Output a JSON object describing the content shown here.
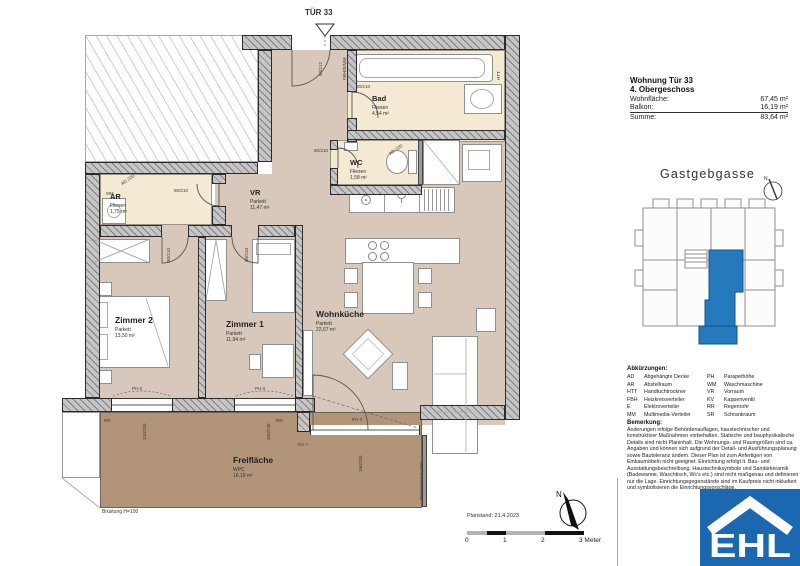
{
  "info": {
    "title": "Wohnung Tür 33",
    "floor": "4. Obergeschoss",
    "rows": [
      {
        "label": "Wohnfläche:",
        "value": "67,45 m²"
      },
      {
        "label": "Balkon:",
        "value": "16,19 m²"
      },
      {
        "label": "Summe:",
        "value": "83,64 m²"
      }
    ]
  },
  "siteplan": {
    "street": "Gastgebgasse"
  },
  "plan": {
    "rooms": [
      {
        "name": "Bad",
        "floor": "Fliesen",
        "area": "4,54 m²"
      },
      {
        "name": "WC",
        "floor": "Fliesen",
        "area": "1,58 m²"
      },
      {
        "name": "AR",
        "floor": "Fliesen",
        "area": "1,75 m²"
      },
      {
        "name": "VR",
        "floor": "Parkett",
        "area": "11,47 m²"
      },
      {
        "name": "Zimmer 1",
        "floor": "Parkett",
        "area": "11,94 m²"
      },
      {
        "name": "Zimmer 2",
        "floor": "Parkett",
        "area": "13,50 m²"
      },
      {
        "name": "Wohnküche",
        "floor": "Parkett",
        "area": "22,67 m²"
      },
      {
        "name": "Freifläche",
        "floor": "WPC",
        "area": "16,19 m²"
      }
    ],
    "annotations": {
      "tuer": "TÜR 33",
      "entry_dim": "90/212",
      "installs": "FBH/E/MM",
      "door_dim": "80/210",
      "ad": "AD 220",
      "htt": "HTT",
      "wm": "WM",
      "ph0": "PH 0",
      "rr": "RR",
      "kv": "KV ×",
      "win_dim": "200/235",
      "terrace_door_dim": "190/235",
      "bruestung": "Brüstung H=100",
      "trennwand": "Trennwand H=200",
      "north": "N"
    }
  },
  "abbreviations": {
    "heading": "Abkürzungen:",
    "items": [
      {
        "abbr": "AD",
        "term": "Abgehängte Decke"
      },
      {
        "abbr": "AR",
        "term": "Abstellraum"
      },
      {
        "abbr": "HTT",
        "term": "Handtuchtrockner"
      },
      {
        "abbr": "FBH",
        "term": "Heizkreisverteiler"
      },
      {
        "abbr": "E",
        "term": "Elektroverteiler"
      },
      {
        "abbr": "MM",
        "term": "Multimedia-Verteiler"
      },
      {
        "abbr": "PH",
        "term": "Parapethöhe"
      },
      {
        "abbr": "WM",
        "term": "Waschmaschine"
      },
      {
        "abbr": "VR",
        "term": "Vorraum"
      },
      {
        "abbr": "KV",
        "term": "Kappenventil"
      },
      {
        "abbr": "RR",
        "term": "Regenrohr"
      },
      {
        "abbr": "SR",
        "term": "Schrankraum"
      }
    ]
  },
  "remark": {
    "heading": "Bemerkung:",
    "text": "Änderungen infolge Behördenauflagen, haustechnischer und konstruktiver Maßnahmen vorbehalten. Statische und bauphysikalische Details sind nicht Planinhalt. Die Wohnungs- und Raumgrößen sind ca. Angaben und können sich aufgrund der Detail- und Ausführungsplanung sowie Bautoleranz ändern. Dieser Plan ist zum Anfertigen von Einbaumöbeln nicht geeignet. Einrichtung erfolgt lt. Bau- und Ausstattungsbeschreibung. Haustechniksymbole und Sanitärkeramik (Badewanne, Waschtisch, Wc's etc.) sind nicht maßgenau und definieren nur die Lage. Einrichtungsgegenstände sind im Kaufpreis nicht inkludiert und symbolisieren die Einrichtungsvorschläge."
  },
  "footer": {
    "planstand": "Planstand: 21.4.2023",
    "scale_ticks": [
      "0",
      "1",
      "2",
      "3 Meter"
    ]
  },
  "logo": {
    "text": "EHL",
    "color": "#1c68b0"
  },
  "colors": {
    "parquet": "#d7c8bb",
    "tiles": "#f4ead4",
    "terrace": "#b29479",
    "highlight_blue": "#2579bd"
  }
}
